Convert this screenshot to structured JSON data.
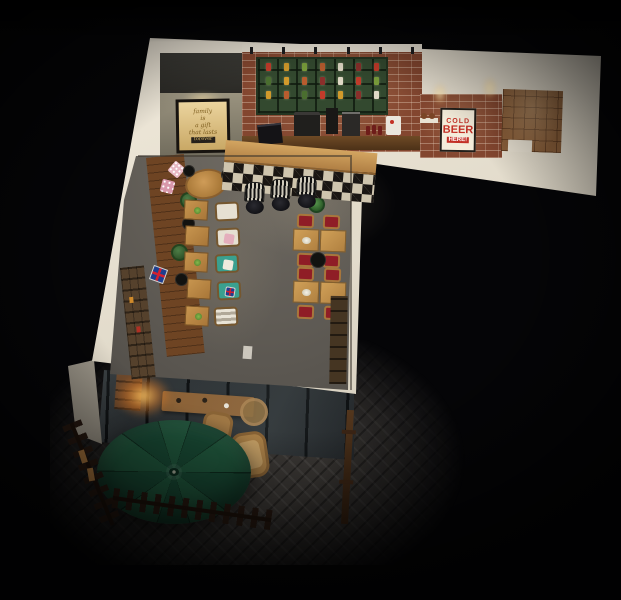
{
  "scene": {
    "description": "Overhead 3D render of an L-shaped cafe-bar interior at night with a glass storefront and outdoor patio",
    "view": "bird's-eye axonometric",
    "lighting": "dark surroundings with warm interior spotlights"
  },
  "signs": {
    "family_poster": {
      "line1": "family",
      "line2": "is",
      "line3": "a gift",
      "line4": "that lasts",
      "line5": "forever"
    },
    "beer_sign": {
      "word1": "COLD",
      "word2": "BEER",
      "word3": "HERE!"
    }
  },
  "palette": {
    "background": "#050507",
    "wall_cap": "#e9e2d4",
    "brick": "#83462f",
    "shelf_green": "#33492f",
    "bar_wood": "#c1924f",
    "checker_dark": "#1a1613",
    "checker_light": "#cfc5ae",
    "dining_floor": "#5a5650",
    "umbrella_green": "#1e5239",
    "teal_chair": "#3aa08f",
    "red_cushion": "#8f1d26",
    "tile_room_floor": "#8a5f3a",
    "fence_wood": "#261810",
    "paving": "#3b3835",
    "poster_paper": "#d8bb84",
    "beer_sign_red": "#c33026"
  },
  "shelf": {
    "jar_colors": [
      "#c23b2a",
      "#d29a2b",
      "#7a9e3b",
      "#b85c2e",
      "#e0d9c6",
      "#8a2f2b",
      "#c23b2a",
      "#4a6e2f",
      "#d29a2b",
      "#b85c2e",
      "#8a2f2b",
      "#e0d9c6",
      "#c23b2a",
      "#7a9e3b",
      "#d29a2b",
      "#b85c2e",
      "#4a6e2f",
      "#c23b2a",
      "#d29a2b",
      "#8a2f2b",
      "#e0d9c6"
    ]
  },
  "furniture": {
    "left_row_cafe_tables": 5,
    "armchairs": 5,
    "bar_stools": 3,
    "red_cushion_chairs": 8,
    "wood_dining_tables": 4,
    "patio_umbrellas": 1,
    "wicker_chairs": 2,
    "pendant_lamps_black": 5,
    "pendant_lamps_green": 1
  }
}
